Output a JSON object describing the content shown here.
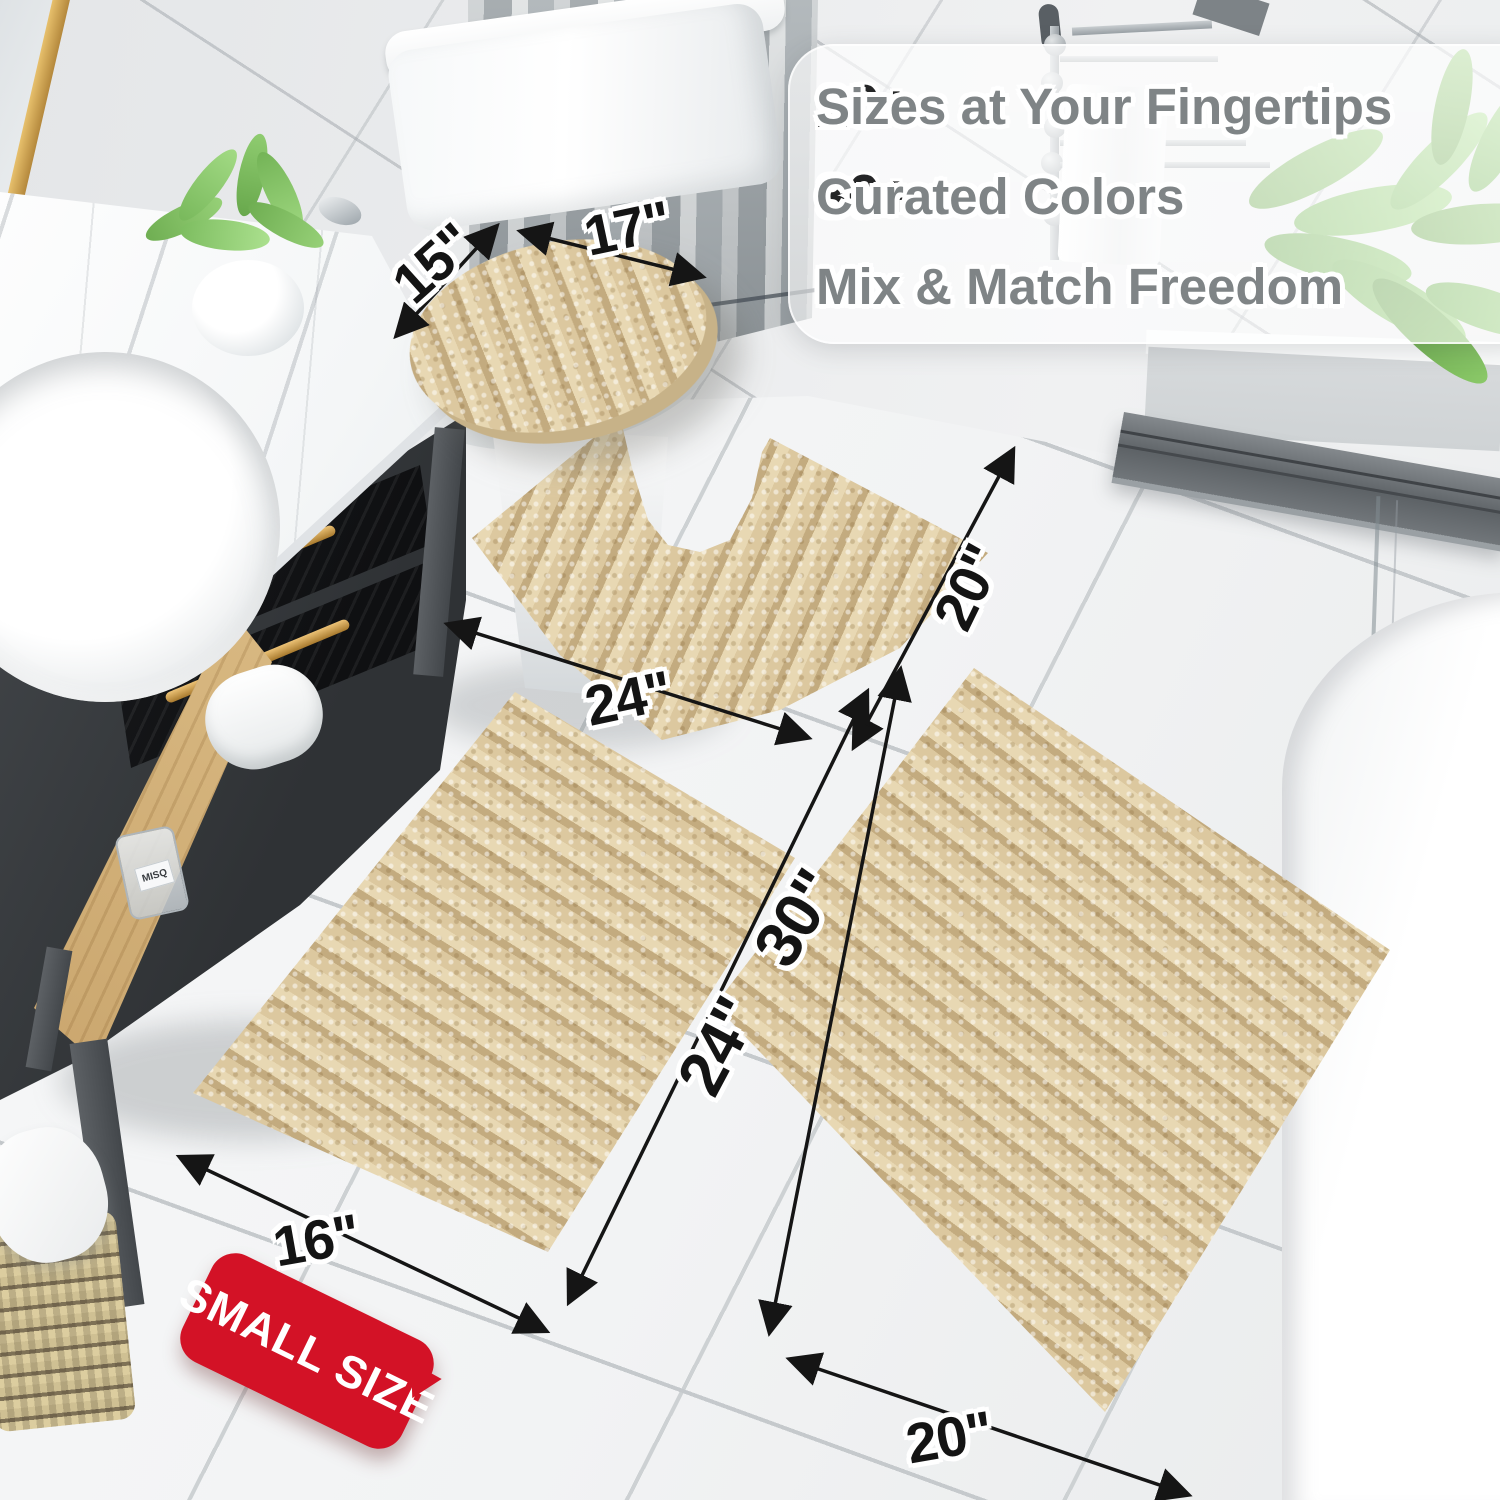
{
  "banner": {
    "items": [
      {
        "check": "✔",
        "number": "20+",
        "label": "Sizes at Your Fingertips"
      },
      {
        "check": "✔",
        "number": "30+",
        "label": "Curated Colors"
      },
      {
        "check": "✔",
        "number": "",
        "label": "Mix & Match Freedom"
      }
    ]
  },
  "measurements": {
    "lid_width": "15\"",
    "lid_length": "17\"",
    "contour_width": "24\"",
    "contour_height": "20\"",
    "small_length": "24\"",
    "large_length": "30\"",
    "small_width": "16\"",
    "large_width": "20\""
  },
  "badge": {
    "label": "SMALL SIZE"
  },
  "vanity": {
    "bottle_label": "MISQ"
  },
  "colors": {
    "rug_beige": "#d8c49c",
    "badge_red": "#d31226",
    "gold_hardware": "#c89a44",
    "check_gray": "#8f9496",
    "text_gray": "#7f8486",
    "number_black": "#242526"
  }
}
